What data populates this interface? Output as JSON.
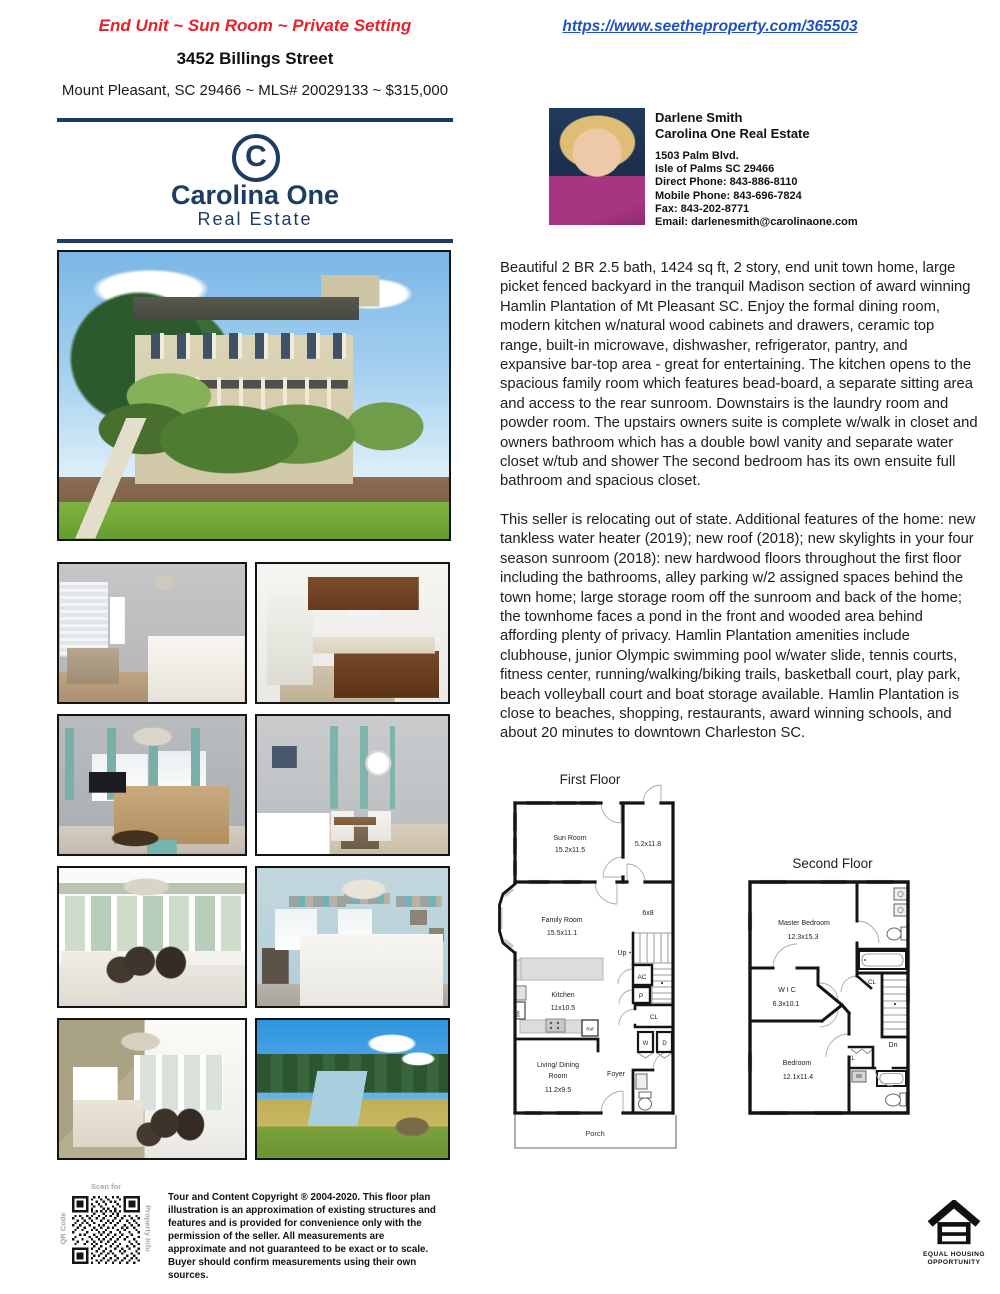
{
  "colors": {
    "accent_red": "#e8212b",
    "link_blue": "#2150c4",
    "brand_navy": "#1d3c63"
  },
  "header": {
    "tagline": "End Unit ~ Sun Room ~ Private Setting",
    "url": "https://www.seetheproperty.com/365503",
    "address": "3452 Billings Street",
    "subline": "Mount Pleasant, SC 29466 ~ MLS# 20029133 ~ $315,000"
  },
  "brand": {
    "initial": "C",
    "name": "Carolina One",
    "tagline": "Real Estate"
  },
  "agent": {
    "name": "Darlene Smith",
    "company": "Carolina One Real Estate",
    "lines": [
      "1503 Palm Blvd.",
      "Isle of Palms SC 29466",
      "Direct Phone: 843-886-8110",
      "Mobile Phone: 843-696-7824",
      "Fax: 843-202-8771",
      "Email: darlenesmith@carolinaone.com"
    ]
  },
  "description": {
    "para1": "Beautiful 2 BR 2.5 bath, 1424 sq ft, 2 story, end unit town home, large picket fenced backyard in the tranquil Madison section of award winning Hamlin Plantation of Mt Pleasant SC. Enjoy the formal dining room, modern kitchen w/natural wood cabinets and drawers, ceramic top range, built-in microwave, dishwasher, refrigerator, pantry, and expansive bar-top area - great for entertaining. The kitchen opens to the spacious family room which features bead-board, a separate sitting area and access to the rear sunroom. Downstairs is the laundry room and powder room. The upstairs owners suite is complete w/walk in closet and owners bathroom which has a double bowl vanity and separate water closet w/tub and shower The second bedroom has its own ensuite full bathroom and spacious closet.",
    "para2": "This seller is relocating out of state. Additional features of the home: new tankless water heater (2019); new roof (2018); new skylights in your four season sunroom (2018): new hardwood floors throughout the first floor including the bathrooms, alley parking w/2 assigned spaces behind the town home; large storage room off the sunroom and back of the home; the townhome faces a pond in the front and wooded area behind affording plenty of privacy. Hamlin Plantation amenities include clubhouse, junior Olympic swimming pool w/water slide, tennis courts, fitness center, running/walking/biking trails, basketball court, play park, beach volleyball court and boat storage available. Hamlin Plantation is close to beaches, shopping, restaurants, award winning schools, and about 20 minutes to downtown Charleston SC."
  },
  "floorplan_first": {
    "title": "First Floor",
    "sun_room": "Sun Room",
    "sun_room_dim": "15.2x11.5",
    "storage_dim": "5.2x11.8",
    "family_room": "Family Room",
    "family_room_dim": "15.5x11.1",
    "hall_dim": "6x8",
    "up": "Up",
    "ac": "AC",
    "p": "P",
    "cl": "CL",
    "w": "W",
    "d": "D",
    "ref": "Ref",
    "dw": "DW",
    "kitchen": "Kitchen",
    "kitchen_dim": "11x10.5",
    "living_line1": "Living/ Dining",
    "living_line2": "Room",
    "living_dim": "11.2x9.5",
    "foyer": "Foyer",
    "porch": "Porch"
  },
  "floorplan_second": {
    "title": "Second Floor",
    "master": "Master Bedroom",
    "master_dim": "12.3x15.3",
    "wic": "W I C",
    "wic_dim": "6.3x10.1",
    "cl_upper": "CL",
    "cl_lower": "CL",
    "dn": "Dn",
    "bedroom": "Bedroom",
    "bedroom_dim": "12.1x11.4"
  },
  "qr": {
    "top": "Scan for",
    "left": "QR Code",
    "right": "Property Info"
  },
  "disclaimer": "Tour and Content Copyright ® 2004-2020. This floor plan illustration is an approximation of existing structures and features and is provided for convenience only with the permission of the seller. All measurements are approximate and not guaranteed to be exact or to scale. Buyer should confirm measurements using their own sources.",
  "equal_housing": {
    "line1": "EQUAL HOUSING",
    "line2": "OPPORTUNITY"
  }
}
